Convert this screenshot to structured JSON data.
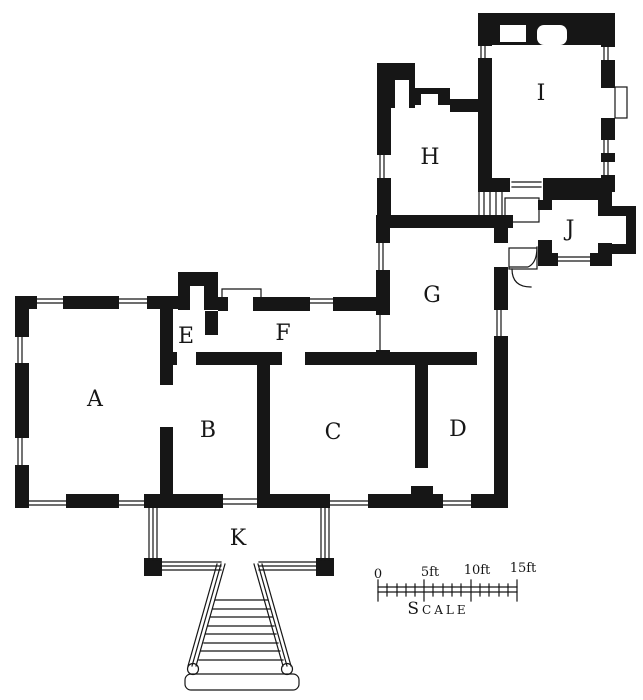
{
  "figure": {
    "type": "architectural-floor-plan"
  },
  "rooms": [
    {
      "label": "A"
    },
    {
      "label": "B"
    },
    {
      "label": "C"
    },
    {
      "label": "D"
    },
    {
      "label": "E"
    },
    {
      "label": "F"
    },
    {
      "label": "G"
    },
    {
      "label": "H"
    },
    {
      "label": "I"
    },
    {
      "label": "J"
    },
    {
      "label": "K"
    }
  ],
  "scale_bar": {
    "ticks": [
      "0",
      "5ft",
      "10ft",
      "15ft"
    ],
    "caption": "Scale",
    "unit": "feet",
    "major_interval_ft": 5,
    "total_ft": 15
  },
  "colors": {
    "ink": "#161616",
    "paper": "#ffffff"
  }
}
